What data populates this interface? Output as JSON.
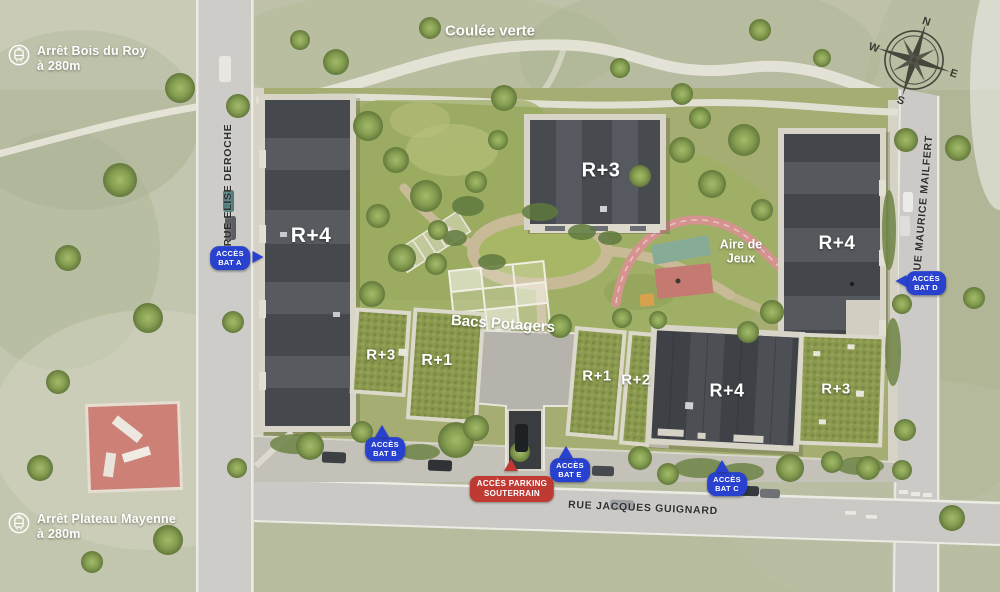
{
  "transit_stops": [
    {
      "id": "bois-du-roy",
      "line1": "Arrêt Bois du Roy",
      "line2": "à 280m"
    },
    {
      "id": "plateau-mayenne",
      "line1": "Arrêt Plateau Mayenne",
      "line2": "à 280m"
    }
  ],
  "streets": {
    "left": "RUE ELISE DEROCHE",
    "right": "RUE MAURICE MAILFERT",
    "bottom": "RUE JACQUES GUIGNARD"
  },
  "landmarks": {
    "coulee_verte": "Coulée verte",
    "aire_de_jeux_line1": "Aire de",
    "aire_de_jeux_line2": "Jeux",
    "bacs_potagers": "Bacs Potagers"
  },
  "buildings": {
    "west": "R+4",
    "north": "R+3",
    "east": "R+4",
    "southwest_a": "R+3",
    "southwest_b": "R+1",
    "south_a": "R+1",
    "south_b": "R+2",
    "southeast_a": "R+4",
    "southeast_b": "R+3"
  },
  "access_points": [
    {
      "id": "bat-a",
      "line1": "ACCÈS",
      "line2": "BAT A",
      "direction": "right"
    },
    {
      "id": "bat-b",
      "line1": "ACCÈS",
      "line2": "BAT B",
      "direction": "up"
    },
    {
      "id": "bat-e",
      "line1": "ACCÈS",
      "line2": "BAT E",
      "direction": "up"
    },
    {
      "id": "bat-c",
      "line1": "ACCÈS",
      "line2": "BAT C",
      "direction": "up"
    },
    {
      "id": "bat-d",
      "line1": "ACCÈS",
      "line2": "BAT D",
      "direction": "left"
    }
  ],
  "parking_access": {
    "line1": "ACCÈS PARKING",
    "line2": "SOUTERRAIN"
  },
  "compass": {
    "n": "N",
    "e": "E",
    "s": "S",
    "w": "W"
  },
  "colors": {
    "access_blue": "#2841cf",
    "access_red": "#bf3a33",
    "roof_dark": "#43464a",
    "roof_green": "#8a994e",
    "path_beige": "#c8ba97",
    "track_pink": "#d4938e"
  }
}
